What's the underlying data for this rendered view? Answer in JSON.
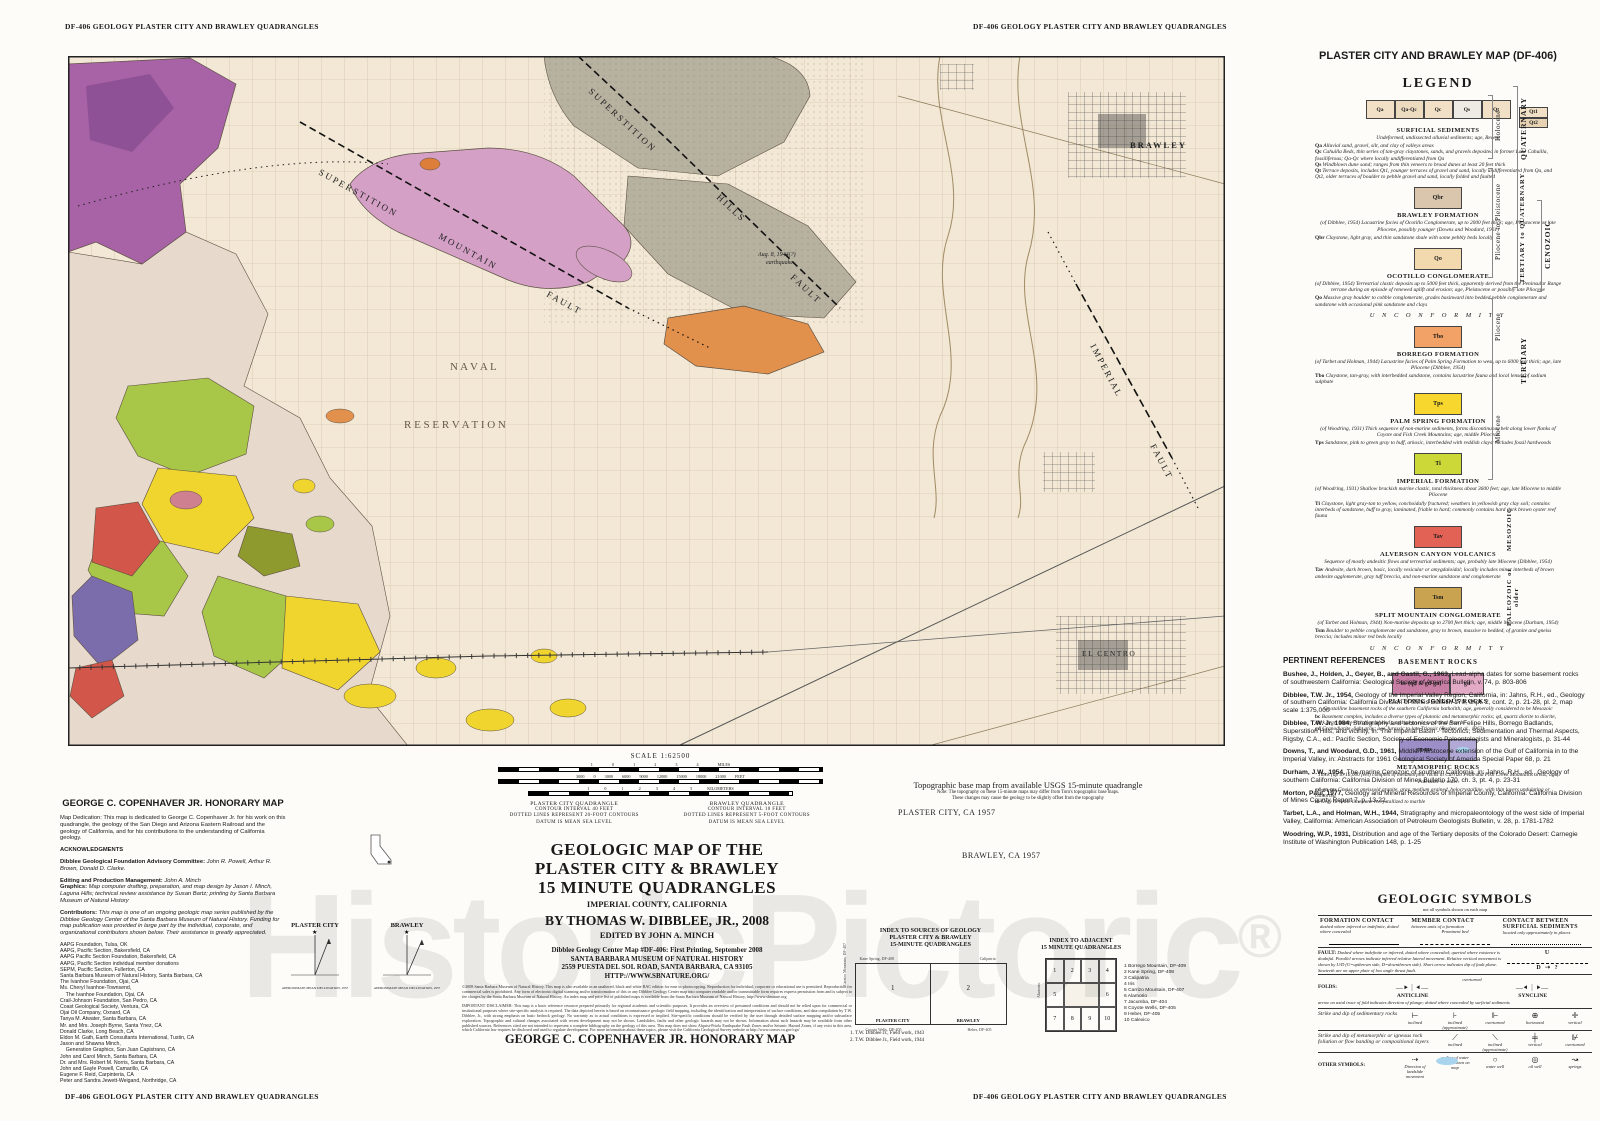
{
  "page": {
    "header_left": "DF-406 GEOLOGY PLASTER CITY AND BRAWLEY QUADRANGLES",
    "header_right": "DF-406 GEOLOGY PLASTER CITY AND BRAWLEY QUADRANGLES",
    "footer_left": "DF-406 GEOLOGY PLASTER CITY AND BRAWLEY QUADRANGLES",
    "footer_right": "DF-406 GEOLOGY PLASTER CITY AND BRAWLEY QUADRANGLES"
  },
  "watermark": {
    "text": "HistoricPictoric",
    "mark": "®"
  },
  "map": {
    "labels": {
      "sup1": "S U P E R S T I T I O N",
      "sup2": "M O U N T A I N",
      "sup3": "F A U L T",
      "hills1": "S U P E R S T I T I O N",
      "hills2": "H I L L S",
      "hills3": "F A U L T",
      "imp1": "I M P E R I A L",
      "imp2": "F A U L T",
      "naval1": "N  A  V  A  L",
      "naval2": "R  E  S  E  R  V  A  T  I  O  N",
      "brawley": "BRAWLEY",
      "elcentro": "EL CENTRO",
      "quake1": "Aug. 8, 1944(?)",
      "quake2": "earthquake"
    }
  },
  "legend": {
    "title": "PLASTER CITY AND BRAWLEY MAP (DF-406)",
    "heading": "LEGEND",
    "surficial": {
      "chips": [
        {
          "label": "Qa",
          "color": "#f1e0c6"
        },
        {
          "label": "Qa-Qc",
          "color": "#eddbc0"
        },
        {
          "label": "Qc",
          "color": "#f1e0c6"
        },
        {
          "label": "Qs",
          "color": "#edebe3"
        },
        {
          "label": "Qt",
          "color": "#f1e0c6"
        }
      ],
      "chip_t1": "Qt1",
      "chip_t2": "Qt2",
      "chip_t1_color": "#f1e0c6",
      "chip_t2_color": "#e7d2b4",
      "heading": "SURFICIAL SEDIMENTS",
      "intro": "Undeformed, undissected alluvial sediments; age, Recent",
      "entries": [
        {
          "code": "Qa",
          "text": "Alluvial sand, gravel, silt, and clay of valleys areas"
        },
        {
          "code": "Qc",
          "text": "Cahuilla Beds, thin series of tan-gray claystones, sands, and gravels deposited in former Lake Cahuilla, fossiliferous; Qa-Qc where locally undifferentiated from Qa"
        },
        {
          "code": "Qs",
          "text": "Windblown dune sand; ranges from thin veneers to broad dunes at least 20 feet thick"
        },
        {
          "code": "Qt",
          "text": "Terrace deposits, includes Qt1, younger terraces of gravel and sand, locally undifferentiated from Qa, and Qt2, older terraces of boulder to pebble gravel and sand, locally folded and faulted"
        }
      ]
    },
    "formations": [
      {
        "chip_label": "Qbr",
        "chip_color": "#d9c6ad",
        "heading": "BRAWLEY FORMATION",
        "intro": "(of Dibblee, 1954) Lacustrine facies of Ocotillo Conglomerate, up to 2000 feet thick; age, Pleistocene or late Pliocene, possibly younger (Downs and Woodard, 1961)",
        "entry_code": "Qbr",
        "entry_text": "Claystone, light gray, and thin sandstone shale with some pebbly beds locally",
        "after": ""
      },
      {
        "chip_label": "Qo",
        "chip_color": "#f3d9ae",
        "heading": "OCOTILLO CONGLOMERATE",
        "intro": "(of Dibblee, 1954) Terrestrial clastic deposits up to 5000 feet thick, apparently derived from the Peninsular Range terrane during an episode of renewed uplift and erosion; age, Pleistocene or possibly late Pliocene",
        "entry_code": "Qo",
        "entry_text": "Massive gray boulder to cobble conglomerate, grades basinward into bedded pebble conglomerate and sandstone with occasional pink sandstone and clays",
        "after": "U N C O N F O R M I T Y"
      },
      {
        "chip_label": "Tbo",
        "chip_color": "#f2a266",
        "heading": "BORREGO FORMATION",
        "intro": "(of Tarbet and Holman, 1944) Lacustrine facies of Palm Spring Formation to west, up to 6000 feet thick; age, late Pliocene (Dibblee, 1954)",
        "entry_code": "Tbo",
        "entry_text": "Claystone, tan-gray, with interbedded sandstone, contains lacustrine fauna and local lenses of sodium sulphate",
        "after": ""
      },
      {
        "chip_label": "Tps",
        "chip_color": "#f7d72e",
        "heading": "PALM SPRING FORMATION",
        "intro": "(of Woodring, 1931) Thick sequence of non-marine sediments, forms discontinuous belt along lower flanks of Coyote and Fish Creek Mountains; age, middle Pliocene",
        "entry_code": "Tps",
        "entry_text": "Sandstone, pink to green gray to buff, arkosic, interbedded with reddish clays; includes fossil hardwoods",
        "after": ""
      },
      {
        "chip_label": "Ti",
        "chip_color": "#ccd838",
        "heading": "IMPERIAL FORMATION",
        "intro": "(of Woodring, 1931) Shallow brackish marine clastic, total thickness about 3600 feet; age, late Miocene to middle Pliocene",
        "entry_code": "Ti",
        "entry_text": "Claystone, light gray-tan to yellow, conchoidally fractured; weathers in yellowish gray clay soil; contains interbeds of sandstone, buff to gray, laminated, friable to hard; commonly contains hard dark brown oyster reef fauna",
        "after": ""
      },
      {
        "chip_label": "Tav",
        "chip_color": "#e26256",
        "heading": "ALVERSON CANYON VOLCANICS",
        "intro": "Sequence of mostly andesitic flows and terrestrial sediments; age, probably late Miocene (Dibblee, 1954)",
        "entry_code": "Tav",
        "entry_text": "Andesite, dark brown, basic, locally vesicular or amygdaloidal; locally includes minor interbeds of brown andesite agglomerate, gray tuff breccia, and non-marine sandstone and conglomerate",
        "after": ""
      },
      {
        "chip_label": "Tsm",
        "chip_color": "#c9a34f",
        "heading": "SPLIT MOUNTAIN CONGLOMERATE",
        "intro": "(of Tarbet and Holman, 1944) Non-marine deposits up to 2700 feet thick; age, middle Miocene (Durham, 1954)",
        "entry_code": "Tsm",
        "entry_text": "Boulder to pebble conglomerate and sandstone, gray to brown, massive to bedded, of granite and gneiss breccia; includes minor red beds locally",
        "after": "U N C O N F O R M I T Y"
      }
    ],
    "basement_heading": "BASEMENT ROCKS",
    "plutonic": {
      "chip1": "bc (qd & gd-gn)",
      "chip1_color": "#c87da4",
      "chip2": "gd",
      "chip2_color": "#e3aac6",
      "heading": "PLUTONIC IGNEOUS ROCKS",
      "intro": "Crystalline basement rocks of the southern California batholith; age, generally considered to be Mesozoic",
      "entries": [
        {
          "code": "bc",
          "text": "Basement complex, includes a diverse types of plutonic and metamorphic rocks; qd, quartz diorite to diorite, dark gray, biotite-rich (not labeled); and gd-gn not separated from bc"
        },
        {
          "code": "gd",
          "text": "Granodiorite, light gray; age Jurassic to late Triassic (Bushee et al., 1963)"
        }
      ]
    },
    "metamorphic": {
      "chip1": "gn-ms",
      "chip1_color": "#9c8fc7",
      "chip2": "m",
      "chip2_color": "#b3a9d6",
      "heading": "METAMORPHIC ROCKS",
      "intro": "Thick (up to 16,000 feet) complex of metamorphic rocks in Carrizo Peak and Fish Creek Mountains areas; age, Paleozoic or older",
      "entries": [
        {
          "code": "gd-gn-ms",
          "text": "Gneiss or gneissoid granite, gray, medium grained, holocrystalline, with thin layers undulating or contorted"
        },
        {
          "code": "m",
          "text": "Gray to white limestone recrystallized to marble"
        }
      ]
    },
    "ages": {
      "holocene": "Holocene",
      "plio_pleist": "Pliocene to Pleistocene",
      "pliocene": "Pliocene",
      "miocene": "Miocene",
      "quaternary": "QUATERNARY",
      "tert_quat": "TERTIARY to QUATERNARY",
      "cenozoic": "CENOZOIC",
      "tertiary": "TERTIARY",
      "mesozoic": "MESOZOIC",
      "paleozoic": "PALEOZOIC or older"
    }
  },
  "references": {
    "heading": "PERTINENT REFERENCES",
    "items": [
      {
        "head": "Bushee, J., Holden, J., Geyer, B., and Gastil, G., 1963,",
        "body": "Lead-alpha dates for some basement rocks of southwestern California: Geological Society of America Bulletin, v. 74,  p. 803-806"
      },
      {
        "head": "Dibblee, T.W. Jr., 1954,",
        "body": "Geology of the Imperial Valley Region, California, in: Jahns, R.H., ed., Geology of southern California: California Division of Mines Bulletin 170, chpt. 2, cont. 2, p. 21-28, pl. 2, map scale 1:375,000"
      },
      {
        "head": "Dibblee, T.W. Jr, 1984,",
        "body": "Stratigraphy and tectonics of the San Felipe Hills, Borrego Badlands, Superstition Hills, and vicinity, in: The Imperial Basin - Tectonics, Sedimentation and Thermal Aspects, Rigsby, C.A., ed.: Pacific Section, Society of Economic Paleontologists and Mineralogists, p. 31-44"
      },
      {
        "head": "Downs, T., and Woodard, G.D., 1961,",
        "body": "Middle Pleistocene extension of the Gulf of California in to the Imperial Valley, in: Abstracts for 1961 Geological Society of America Special Paper 68, p. 21"
      },
      {
        "head": "Durham, J.W., 1954,",
        "body": "The marine Cenozoic of southern California, in: Jahns, R.H., ed., Geology of southern California: California Division of Mines Bulletin 170, ch. 3, pt. 4, p. 23-31"
      },
      {
        "head": "Morton, Paul, 1977,",
        "body": "Geology and Mineral Resources of Imperial County, California: California Division of Mines County Report 7, p. 13-22."
      },
      {
        "head": "Tarbet, L.A., and Holman, W.H., 1944,",
        "body": "Stratigraphy and micropaleontology of the west side of Imperial Valley, California: American Association of Petroleum Geologists Bulletin, v. 28, p. 1781-1782"
      },
      {
        "head": "Woodring, W.P., 1931,",
        "body": "Distribution and age of the Tertiary deposits of the Colorado Desert: Carnegie Institute of Washington Publication 148, p. 1-25"
      }
    ]
  },
  "symbols": {
    "title": "GEOLOGIC SYMBOLS",
    "subtitle": "not all symbols shown on each map",
    "c1": "FORMATION CONTACT",
    "c1n": "dashed where inferred or indefinite, dotted where concealed",
    "c2": "MEMBER CONTACT",
    "c2n": "between units of a formation",
    "c2p": "Prominent bed",
    "c3": "CONTACT BETWEEN SURFICIAL SEDIMENTS",
    "c3n": "located only approximately in places",
    "fault": "FAULT:",
    "u": "U",
    "d": "D",
    "fault_note": "Dashed where indefinite or inferred, dotted where concealed; queried where existence is doubtful. Parallel arrows indicate inferred relative lateral movement. Relative vertical movement is shown by U/D (U=upthrown side, D=downthrown side). Short arrow indicates dip of fault plane. Sawteeth are on upper plate of low angle thrust fault.",
    "folds": "FOLDS:",
    "overturned": "overturned",
    "anticline": "ANTICLINE",
    "syncline": "SYNCLINE",
    "folds_note": "arrow on axial trace of fold indicates direction of plunge; dotted where concealed by surficial sediments",
    "sed_label": "Strike and dip of sedimentary rocks",
    "sed_terms": [
      {
        "glyph": "⊢",
        "term": "inclined"
      },
      {
        "glyph": "⊦",
        "term": "inclined (approximate)"
      },
      {
        "glyph": "⊩",
        "term": "overturned"
      },
      {
        "glyph": "⊕",
        "term": "horizontal"
      },
      {
        "glyph": "✛",
        "term": "vertical"
      }
    ],
    "met_label": "Strike and dip of metamorphic or igneous rock foliation or flow banding or compositional layers",
    "met_terms": [
      {
        "glyph": "⟋",
        "term": "inclined"
      },
      {
        "glyph": "⟍",
        "term": "inclined (approximate)"
      },
      {
        "glyph": "╪",
        "term": "vertical"
      },
      {
        "glyph": "⊮",
        "term": "overturned"
      }
    ],
    "other": "OTHER SYMBOLS:",
    "other_terms": [
      {
        "glyph": "⇢",
        "term": "Direction of landslide movement"
      },
      {
        "glyph": "",
        "term": "outline of water bodies shown on map"
      },
      {
        "glyph": "○",
        "term": "water well"
      },
      {
        "glyph": "◎",
        "term": "oil well"
      },
      {
        "glyph": "↝",
        "term": "springs"
      }
    ]
  },
  "honorary": {
    "title": "GEORGE C. COPENHAVER JR. HONORARY MAP",
    "dedication": "Map Dedication: This map is dedicated to George C. Copenhaver Jr. for his work on this quadrangle, the geology of the San Diego and Arizona Eastern Railroad and the geology of California, and for his contributions to the understanding of California geology.",
    "ack": "ACKNOWLEDGMENTS",
    "committee_label": "Dibblee Geological Foundation Advisory Committee:",
    "committee": "John R. Powell, Arthur R. Brown, Donald D. Clarke.",
    "editing_label": "Editing and Production Management:",
    "editing": "John A. Minch",
    "graphics_label": "Graphics:",
    "graphics": "Map computer drafting, preparation, and map design by Jason I. Minch, Laguna Hills; technical review assistance by Susan Bartz; printing by Santa Barbara Museum of Natural History",
    "contrib_label": "Contributors:",
    "contrib_intro": "This map is one of an ongoing geologic map series published by the Dibblee Geology Center of the Santa Barbara Museum of Natural History. Funding for map publication was provided in large part by the individual, corporate, and organizational contributors shown below. Their assistance is greatly appreciated.",
    "contributors": [
      "AAPG Foundation, Tulsa, OK",
      "AAPG, Pacific Section, Bakersfield, CA",
      "AAPG Pacific Section Foundation, Bakersfield, CA",
      "AAPG, Pacific Section individual member donations",
      "SEPM, Pacific Section, Fullerton, CA",
      "Santa Barbara Museum of Natural History, Santa Barbara, CA",
      "The Ivanhoe Foundation, Ojai, CA",
      "Ms. Cheryl Ivanhoe-Townsend,",
      "    The Ivanhoe Foundation, Ojai, CA",
      "Crail-Johnson Foundation, San Pedro, CA",
      "Coast Geological Society, Ventura, CA",
      "Ojai Oil Company, Oxnard, CA",
      "Tanya M. Atwater, Santa Barbara, CA",
      "Mr. and Mrs. Joseph Byrne, Santa Ynez, CA",
      "Donald Clarke, Long Beach, CA",
      "Eldon M. Gath, Earth Consultants International, Tustin, CA",
      "Jason and Shawna Minch,",
      "    Generation Graphics, San Juan Capistrano, CA",
      "John and Carol Minch, Santa Barbara, CA",
      "Dr. and Mrs. Robert M. Norris, Santa Barbara, CA",
      "John and Gayle Powell, Camarillo, CA",
      "Eugene F. Reid, Carpinteria, CA",
      "Peter and Sandra Jewett-Weigand, Northridge, CA"
    ]
  },
  "title_block": {
    "line1": "GEOLOGIC MAP OF THE",
    "line2": "PLASTER CITY & BRAWLEY",
    "line3": "15 MINUTE QUADRANGLES",
    "county": "IMPERIAL COUNTY, CALIFORNIA",
    "author": "BY THOMAS W. DIBBLEE, JR., 2008",
    "editor": "EDITED BY JOHN A. MINCH",
    "pub1": "Dibblee Geology Center Map #DF-406:    First Printing, September 2008",
    "pub2": "SANTA BARBARA MUSEUM OF NATURAL HISTORY",
    "pub3": "2559 PUESTA DEL SOL ROAD, SANTA BARBARA, CA 93105",
    "pub4": "HTTP://WWW.SBNATURE.ORG/",
    "fine1": "©2008 Santa Barbara Museum of Natural History. This map is also available in an unaltered, black and white BAC edition for ease in photocopying. Reproduction for individual, corporate or educational use is permitted. Reproduction for commercial sales is prohibited. Any form of electronic digital scanning and/or transformation of this or any Dibblee Geology Center map into computer readable and/or transmittable form requires express permission from and is subject to fee charges by the Santa Barbara Museum of Natural History. An index map and price list of published maps is available from the Santa Barbara Museum of Natural History, http://www.sbnature.org",
    "fine2": "IMPORTANT DISCLAIMER: This map is a basic reference resource prepared primarily for regional academic and scientific purposes. It provides an overview of presumed conditions and should not be relied upon for commercial or institutional purposes where site-specific analysis is required. The data depicted herein is based on reconnaissance geologic field mapping, including the identification and interpretation of surface conditions, and data compilation by T.W. Dibblee, Jr., with strong emphasis on basic bedrock geology. No warranty as to actual conditions is expressed or implied. Site-specific conditions should be verified by the user through detailed surface mapping and/or subsurface exploration. Topographic and cultural changes associated with recent development may not be shown. Landslides, faults and other geologic hazards may not be shown. Information about such hazards may be available from other published sources. References cited are not intended to represent a complete bibliography on the geology of this area. This map does not show Alquist-Priolo Earthquake Fault Zones and/or Seismic Hazard Zones, if any exist in this area, which California law requires be disclosed and used to regulate development. For more information about these topics, please visit the California Geological Survey website at http://www.consrv.ca.gov/cgs/",
    "honorary_footer": "GEORGE C. COPENHAVER JR. HONORARY MAP"
  },
  "scale": {
    "title": "SCALE  1:62500",
    "miles_ticks": "1 0 1 2 3 4 MILES",
    "feet_ticks": "3000 0 3000 6000 9000 12000 15000 18000 21000 FEET",
    "km_ticks": "1 0 1 2 3 4 5 KILOMETERS",
    "left_quad": [
      "PLASTER CITY QUADRANGLE",
      "CONTOUR INTERVAL 40 FEET",
      "DOTTED LINES REPRESENT 20-FOOT CONTOURS",
      "DATUM IS MEAN SEA LEVEL"
    ],
    "right_quad": [
      "BRAWLEY QUADRANGLE",
      "CONTOUR INTERVAL 10 FEET",
      "DOTTED LINES REPRESENT 5-FOOT CONTOURS",
      "DATUM IS MEAN SEA LEVEL"
    ]
  },
  "base_note": {
    "line1": "Topographic base map from available USGS 15-minute quadrangle",
    "line2": "Note: The topography on these 15-minute maps may differ from Tom's topographic base maps.",
    "line3": "These changes may cause the geology to be slightly offset from the topography",
    "quad1": "PLASTER CITY, CA 1957",
    "quad2": "BRAWLEY, CA 1957"
  },
  "index_sources": {
    "title1": "INDEX TO SOURCES OF GEOLOGY",
    "title2": "PLASTER CITY & BRAWLEY",
    "title3": "15-MINUTE QUADRANGLES",
    "top_left": "Kane Spring, DF-408",
    "top_right": "Calipatria",
    "left": "Carrizo Mountain, DF-407",
    "right": "Alamorio",
    "bottom_left": "Coyote Wells, DF-405",
    "bottom_right": "Heber, DF-405",
    "cell1_num": "1",
    "cell1_name": "PLASTER CITY",
    "cell2_num": "2",
    "cell2_name": "BRAWLEY",
    "note1": "1.  T.W. Dibblee Jr., Field work, 1943",
    "note2": "2.  T.W. Dibblee Jr., Field work, 1944"
  },
  "index_adjacent": {
    "title1": "INDEX TO ADJACENT",
    "title2": "15 MINUTE QUADRANGLES",
    "grid": [
      "1",
      "2",
      "3",
      "4",
      "5",
      "6",
      "7",
      "8",
      "9",
      "10"
    ],
    "items": [
      "1  Borrego Mountain, DF-409",
      "2  Kane Spring, DF-408",
      "3  Calipatria",
      "4  Iris",
      "5  Carrizo Mountain, DF-407",
      "6  Alamorio",
      "7  Jacumba, DF-404",
      "8  Coyote Wells, DF-405",
      "9  Heber, DF-405",
      "10 Calexico"
    ]
  },
  "declination": {
    "fig1": "PLASTER CITY",
    "fig2": "BRAWLEY",
    "caption": "APPROXIMATE MEAN DECLINATION, 1957"
  }
}
